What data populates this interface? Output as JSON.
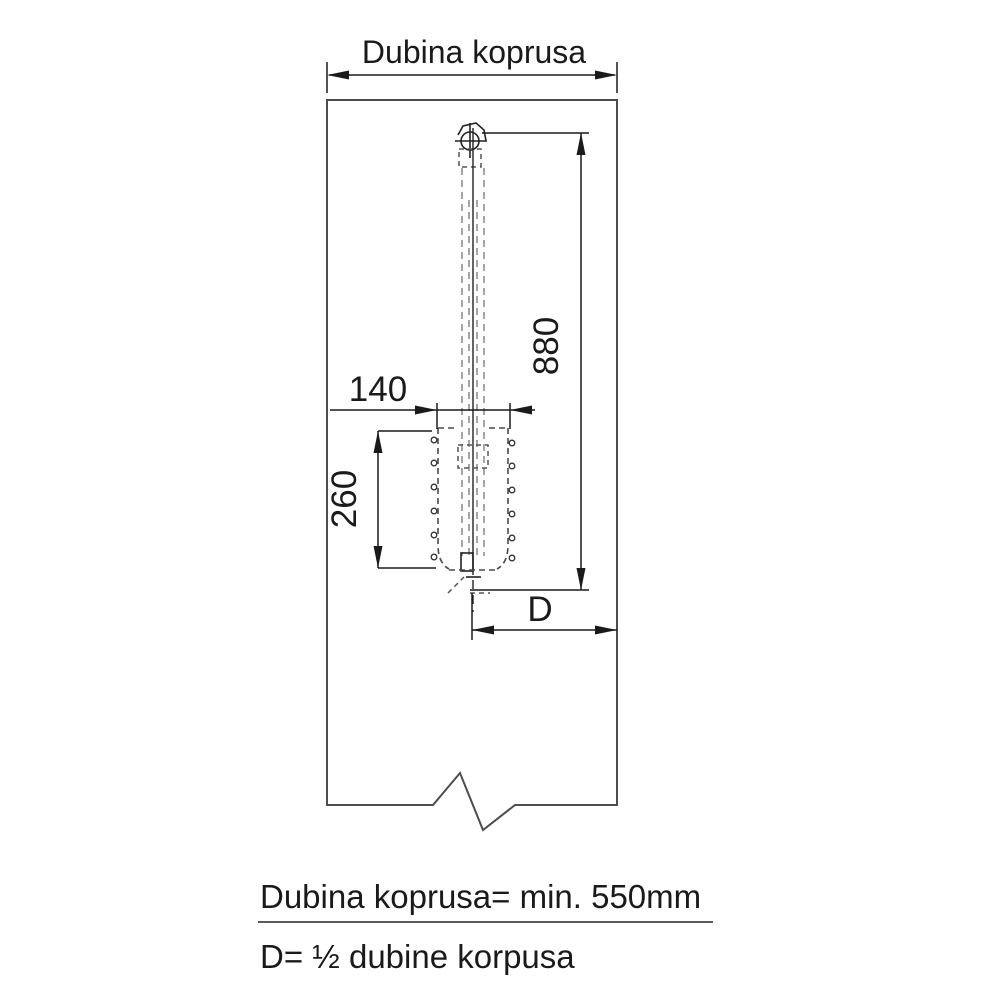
{
  "diagram": {
    "title_dimension": "Dubina koprusa",
    "dims": {
      "height_rod": "880",
      "basket_width": "140",
      "basket_height": "260",
      "half_depth": "D"
    },
    "notes": {
      "line1": "Dubina koprusa= min. 550mm",
      "line2": "D= ½ dubine korpusa"
    },
    "colors": {
      "dimension_lines": "#1a1a1a",
      "cabinet_outline": "#4d4d4d",
      "hidden_lines": "#8f8f8f",
      "background": "#ffffff"
    }
  }
}
